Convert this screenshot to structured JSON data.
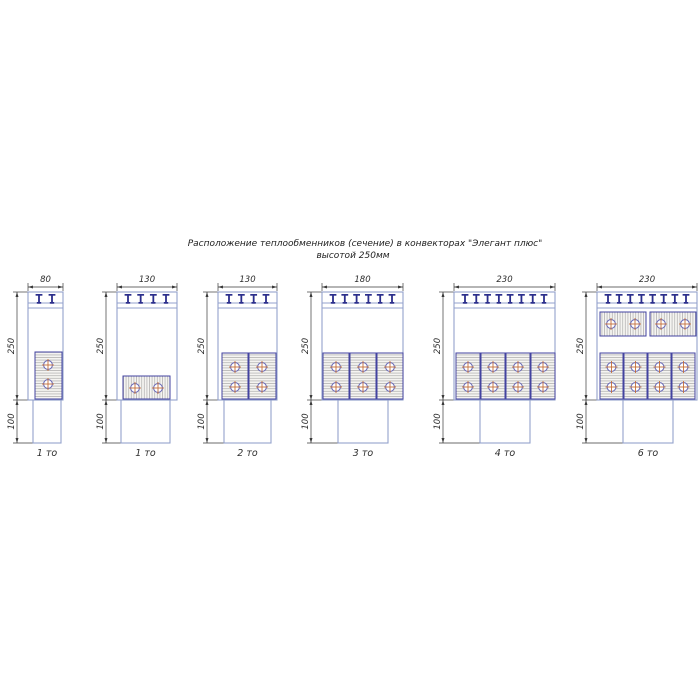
{
  "title": {
    "line1": "Расположение теплообменников (сечение) в конвекторах \"Элегант плюс\"",
    "line2": "высотой 250мм"
  },
  "dims": {
    "height_label": "250",
    "duct_height_label": "100"
  },
  "colors": {
    "body_outline": "#93a1cc",
    "grille_mark": "#2b2e8c",
    "block_border": "#4343a0",
    "block_fill": "#f5f4f1",
    "hatch_line": "#b5b5b5",
    "tube_stroke": "#6e6eb8",
    "tube_cross": "#c46f3a",
    "dimension_line": "#3a3a3a",
    "text": "#2e2e2e",
    "background": "#ffffff"
  },
  "metrics": {
    "body_top": 292,
    "grille_line1": 303,
    "grille_line2": 308,
    "body_bottom": 400,
    "duct_bottom": 443,
    "dim_line_y": 287,
    "dim_text_y": 282,
    "ext_top_y": 283,
    "left_dim_gap": 11,
    "tmark_margin": 11,
    "caption_y": 456,
    "title1_x": 365,
    "title1_y": 246,
    "title2_x": 353,
    "title2_y": 258
  },
  "figures": [
    {
      "width_label": "80",
      "caption": "1 то",
      "body": {
        "x": 28,
        "w": 35
      },
      "duct": {
        "x": 33,
        "w": 28
      },
      "tmarks": 2,
      "blocks": [
        {
          "x": 35,
          "y": 352,
          "w": 27,
          "h": 47,
          "orient": "v"
        }
      ],
      "tubes": [
        [
          48,
          365
        ],
        [
          48,
          384
        ]
      ]
    },
    {
      "width_label": "130",
      "caption": "1 то",
      "body": {
        "x": 117,
        "w": 60
      },
      "duct": {
        "x": 121,
        "w": 49
      },
      "tmarks": 4,
      "blocks": [
        {
          "x": 123,
          "y": 376,
          "w": 47,
          "h": 23,
          "orient": "h"
        }
      ],
      "tubes": [
        [
          135,
          388
        ],
        [
          158,
          388
        ]
      ]
    },
    {
      "width_label": "130",
      "caption": "2 то",
      "body": {
        "x": 218,
        "w": 59
      },
      "duct": {
        "x": 224,
        "w": 47
      },
      "tmarks": 4,
      "blocks": [
        {
          "x": 222,
          "y": 353,
          "w": 26,
          "h": 46,
          "orient": "v"
        },
        {
          "x": 249,
          "y": 353,
          "w": 27,
          "h": 46,
          "orient": "v"
        }
      ],
      "tubes": [
        [
          235,
          367
        ],
        [
          235,
          387
        ],
        [
          262,
          367
        ],
        [
          262,
          387
        ]
      ]
    },
    {
      "width_label": "180",
      "caption": "3 то",
      "body": {
        "x": 322,
        "w": 81
      },
      "duct": {
        "x": 338,
        "w": 50
      },
      "tmarks": 6,
      "blocks": [
        {
          "x": 323,
          "y": 353,
          "w": 26,
          "h": 46,
          "orient": "v"
        },
        {
          "x": 350,
          "y": 353,
          "w": 26,
          "h": 46,
          "orient": "v"
        },
        {
          "x": 377,
          "y": 353,
          "w": 26,
          "h": 46,
          "orient": "v"
        }
      ],
      "tubes": [
        [
          336,
          367
        ],
        [
          336,
          387
        ],
        [
          363,
          367
        ],
        [
          363,
          387
        ],
        [
          390,
          367
        ],
        [
          390,
          387
        ]
      ]
    },
    {
      "width_label": "230",
      "caption": "4 то",
      "body": {
        "x": 454,
        "w": 101
      },
      "duct": {
        "x": 480,
        "w": 50
      },
      "tmarks": 8,
      "blocks": [
        {
          "x": 456,
          "y": 353,
          "w": 24,
          "h": 46,
          "orient": "v"
        },
        {
          "x": 481,
          "y": 353,
          "w": 24,
          "h": 46,
          "orient": "v"
        },
        {
          "x": 506,
          "y": 353,
          "w": 24,
          "h": 46,
          "orient": "v"
        },
        {
          "x": 531,
          "y": 353,
          "w": 24,
          "h": 46,
          "orient": "v"
        }
      ],
      "tubes": [
        [
          468,
          367
        ],
        [
          468,
          387
        ],
        [
          493,
          367
        ],
        [
          493,
          387
        ],
        [
          518,
          367
        ],
        [
          518,
          387
        ],
        [
          543,
          367
        ],
        [
          543,
          387
        ]
      ]
    },
    {
      "width_label": "230",
      "caption": "6 то",
      "body": {
        "x": 597,
        "w": 100
      },
      "duct": {
        "x": 623,
        "w": 50
      },
      "tmarks": 8,
      "blocks": [
        {
          "x": 600,
          "y": 312,
          "w": 46,
          "h": 24,
          "orient": "h"
        },
        {
          "x": 650,
          "y": 312,
          "w": 46,
          "h": 24,
          "orient": "h"
        },
        {
          "x": 600,
          "y": 353,
          "w": 23,
          "h": 46,
          "orient": "v"
        },
        {
          "x": 624,
          "y": 353,
          "w": 23,
          "h": 46,
          "orient": "v"
        },
        {
          "x": 648,
          "y": 353,
          "w": 23,
          "h": 46,
          "orient": "v"
        },
        {
          "x": 672,
          "y": 353,
          "w": 23,
          "h": 46,
          "orient": "v"
        }
      ],
      "tubes": [
        [
          611,
          324
        ],
        [
          635,
          324
        ],
        [
          661,
          324
        ],
        [
          685,
          324
        ],
        [
          611.5,
          367
        ],
        [
          611.5,
          387
        ],
        [
          635.5,
          367
        ],
        [
          635.5,
          387
        ],
        [
          659.5,
          367
        ],
        [
          659.5,
          387
        ],
        [
          683.5,
          367
        ],
        [
          683.5,
          387
        ]
      ]
    }
  ]
}
